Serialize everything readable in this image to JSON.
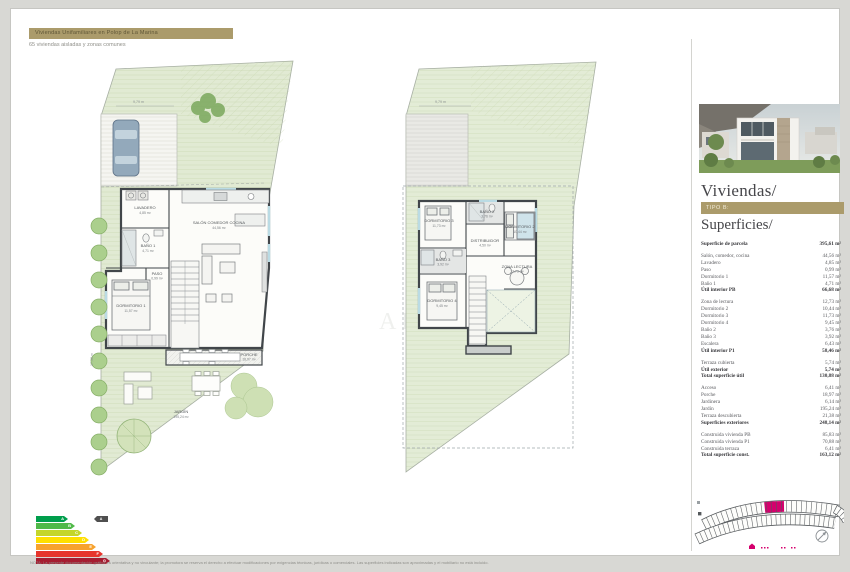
{
  "header": {
    "badge": "Viviendas Unifamiliares en Polop de La Marina",
    "subtitle": "65 viviendas aisladas y zonas comunes"
  },
  "panel": {
    "title": "Viviendas/",
    "type_badge": "TIPO B:",
    "superficies_title": "Superficies/"
  },
  "table": {
    "rows": [
      {
        "label": "Superficie de parcela",
        "value": "395,61 m²",
        "bold": true
      },
      {
        "label": "Salón, comedor, cocina",
        "value": "44,56 m²",
        "gap": true
      },
      {
        "label": "Lavadero",
        "value": "4,85 m²"
      },
      {
        "label": "Paso",
        "value": "0,99 m²"
      },
      {
        "label": "Dormitorio 1",
        "value": "11,57 m²"
      },
      {
        "label": "Baño 1",
        "value": "4,71 m²"
      },
      {
        "label": "Útil interior PB",
        "value": "66,68 m²",
        "bold": true
      },
      {
        "label": "Zona de lectura",
        "value": "12,73 m²",
        "gap": true
      },
      {
        "label": "Dormitorio 2",
        "value": "10,44 m²"
      },
      {
        "label": "Dormitorio 3",
        "value": "11,73 m²"
      },
      {
        "label": "Dormitorio 4",
        "value": "9,45 m²"
      },
      {
        "label": "Baño 2",
        "value": "3,76 m²"
      },
      {
        "label": "Baño 3",
        "value": "3,92 m²"
      },
      {
        "label": "Escalera",
        "value": "6,43 m²"
      },
      {
        "label": "Útil interior P1",
        "value": "58,46 m²",
        "bold": true
      },
      {
        "label": "Terraza cubierta",
        "value": "5,74 m²",
        "gap": true
      },
      {
        "label": "Útil exterior",
        "value": "5,74 m²",
        "bold": true
      },
      {
        "label": "Total superficie útil",
        "value": "130,88 m²",
        "bold": true
      },
      {
        "label": "Acceso",
        "value": "6,41 m²",
        "gap": true
      },
      {
        "label": "Porche",
        "value": "18,97 m²"
      },
      {
        "label": "Jardinera",
        "value": "6,14 m²"
      },
      {
        "label": "Jardín",
        "value": "195,24 m²"
      },
      {
        "label": "Terraza descubierta",
        "value": "21,38 m²"
      },
      {
        "label": "Superficies exteriores",
        "value": "248,14 m²",
        "bold": true
      },
      {
        "label": "Construida vivienda PB",
        "value": "85,83 m²",
        "gap": true
      },
      {
        "label": "Construida vivienda P1",
        "value": "70,88 m²"
      },
      {
        "label": "Construida terraza",
        "value": "6,41 m²"
      },
      {
        "label": "Total superficie const.",
        "value": "163,12 m²",
        "bold": true
      }
    ]
  },
  "plans": {
    "pb": {
      "dim_top": "9,79 m",
      "dim_left": "17,38 m",
      "lavadero": {
        "name": "LAVADERO",
        "area": "4,85 m²"
      },
      "bano1": {
        "name": "BAÑO 1",
        "area": "4,71 m²"
      },
      "paso": {
        "name": "PASO",
        "area": "0,99 m²"
      },
      "dormitorio1": {
        "name": "DORMITORIO 1",
        "area": "11,57 m²"
      },
      "salon": {
        "name": "SALÓN COMEDOR COCINA",
        "area": "44,56 m²"
      },
      "porche": {
        "name": "PORCHE",
        "area": "18,97 m²"
      },
      "jardin": {
        "name": "JARDÍN",
        "area": "195,24 m²"
      }
    },
    "p1": {
      "dim_top": "9,79 m",
      "dormitorio3": {
        "name": "DORMITORIO 3",
        "area": "11,73 m²"
      },
      "bano2": {
        "name": "BAÑO 2",
        "area": "3,76 m²"
      },
      "dormitorio2": {
        "name": "DORMITORIO 2",
        "area": "10,44 m²"
      },
      "distribuidor": {
        "name": "DISTRIBUIDOR",
        "area": "4,50 m²"
      },
      "bano3": {
        "name": "BAÑO 3",
        "area": "3,92 m²"
      },
      "dormitorio4": {
        "name": "DORMITORIO 4",
        "area": "9,45 m²"
      },
      "zona_lectura": {
        "name": "ZONA LECTURA",
        "area": "12,73 m²"
      }
    }
  },
  "energy": {
    "classes": [
      {
        "letter": "A",
        "color": "#009e4c",
        "width": 32
      },
      {
        "letter": "B",
        "color": "#4fb948",
        "width": 39
      },
      {
        "letter": "C",
        "color": "#c4d62b",
        "width": 46
      },
      {
        "letter": "D",
        "color": "#ffdf00",
        "width": 53
      },
      {
        "letter": "E",
        "color": "#f7a22e",
        "width": 60
      },
      {
        "letter": "F",
        "color": "#e6352c",
        "width": 67
      },
      {
        "letter": "G",
        "color": "#a61c30",
        "width": 74
      }
    ],
    "indicator": "A"
  },
  "watermark": {
    "part1": "b",
    "part2": "AL"
  },
  "footer": {
    "disclaimer": "NOTA: La presente documentación gráfica es orientativa y no vinculante; la promotora se reserva el derecho a efectuar modificaciones por exigencias técnicas, jurídicas o comerciales. Las superficies indicadas son aproximadas y el mobiliario no está incluido."
  },
  "colors": {
    "accent_gold": "#ab9b6b",
    "highlight_magenta": "#d4006d"
  }
}
